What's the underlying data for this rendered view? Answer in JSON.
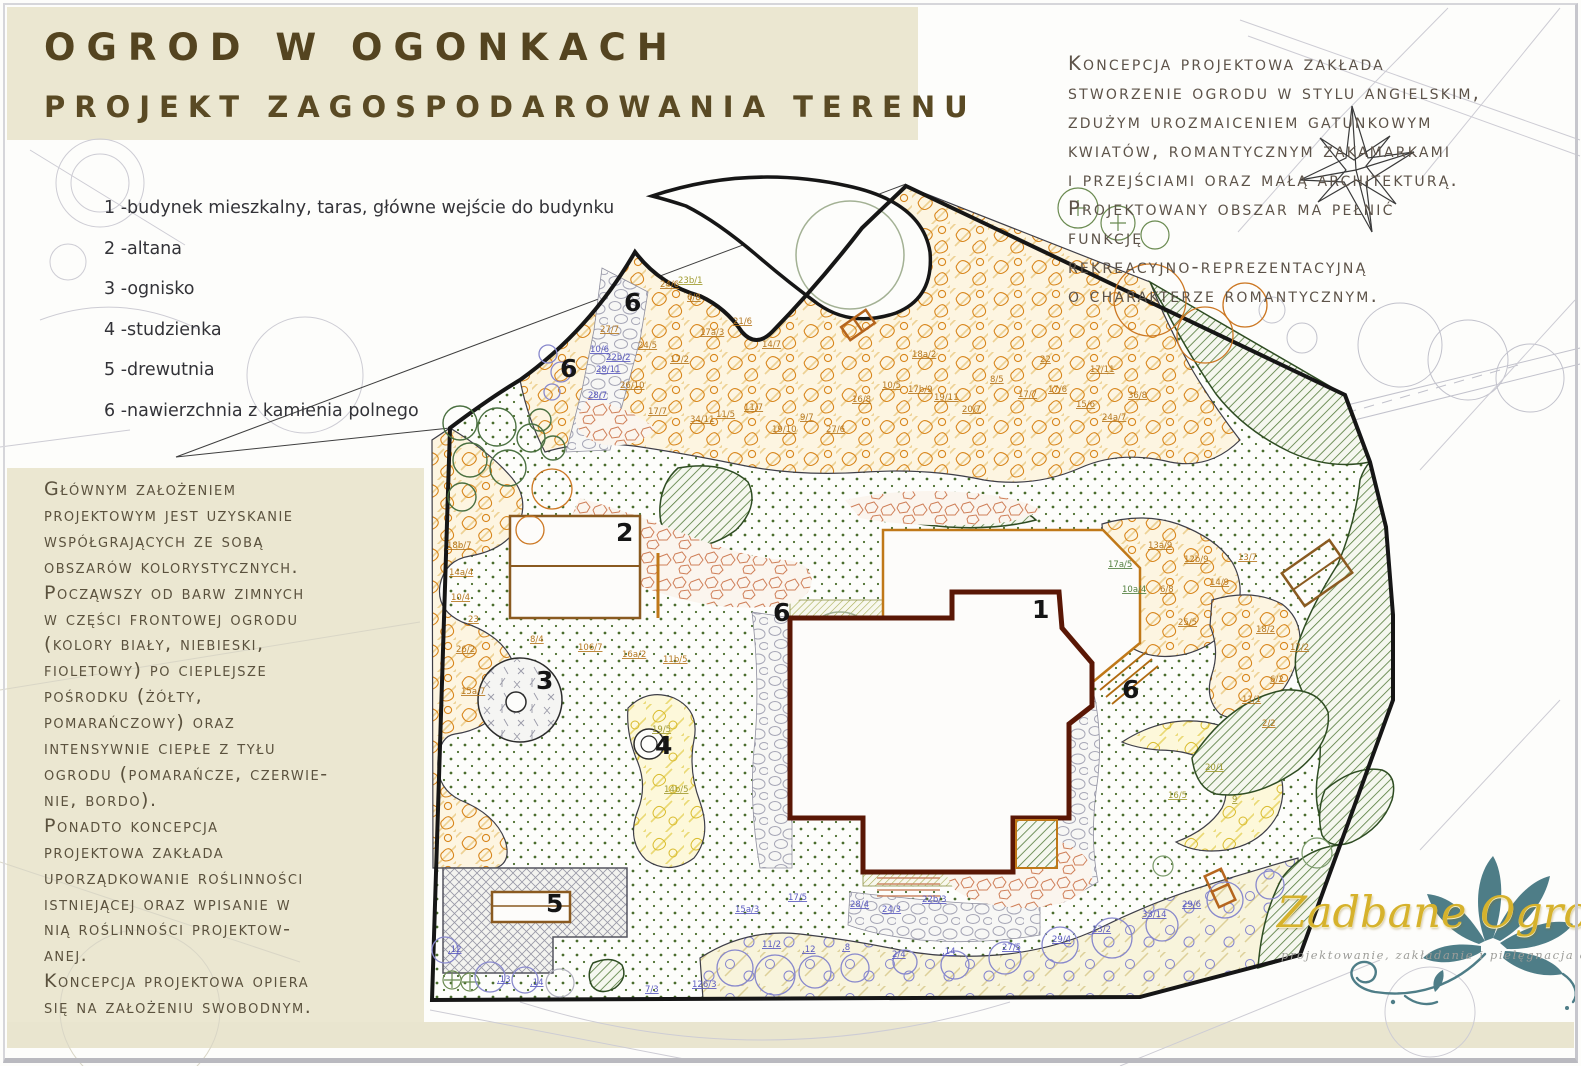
{
  "header": {
    "title_line1": "OGROD W OGONKACH",
    "title_line2": "PROJEKT ZAGOSPODAROWANIA TERENU"
  },
  "legend": {
    "items": [
      "1 -budynek mieszkalny, taras, główne wejście do budynku",
      "2 -altana",
      "3 -ognisko",
      "4 -studzienka",
      "5 -drewutnia",
      "6 -nawierzchnia z kamienia polnego"
    ]
  },
  "concept_note": {
    "lines": [
      "Koncepcja projektowa zakłada",
      "stworzenie ogrodu w stylu angielskim,",
      "zdużym urozmaiceniem gatunkowym",
      "kwiatów, romantycznym zakamarkami",
      "i przejściami oraz małą architekturą.",
      "Projektowany obszar ma pełnić",
      "funkcję",
      "rekreacyjno-reprezentacyjną",
      "o charakterze romantycznym."
    ]
  },
  "design_note": {
    "lines": [
      "Głównym założeniem",
      "projektowym jest uzyskanie",
      "współgrających ze sobą",
      "obszarów kolorystycznych.",
      "Począwszy od barw zimnych",
      "w części frontowej ogrodu",
      "(kolory biały, niebieski,",
      "fioletowy) po cieplejsze",
      "pośrodku (żółty,",
      "pomarańczowy) oraz",
      "intensywnie ciepłe z tyłu",
      "ogrodu (pomarańcze, czerwie-",
      "nie, bordo).",
      "Ponadto koncepcja",
      "projektowa zakłada",
      "uporządkowanie roślinności",
      "istniejącej oraz wpisanie w",
      "nią roślinności projektow-",
      "anej.",
      "Koncepcja projektowa opiera",
      "się na założeniu swobodnym."
    ]
  },
  "plan": {
    "area_labels": [
      {
        "n": "1",
        "x": 1032,
        "y": 618
      },
      {
        "n": "2",
        "x": 616,
        "y": 541
      },
      {
        "n": "3",
        "x": 536,
        "y": 689
      },
      {
        "n": "4",
        "x": 655,
        "y": 754
      },
      {
        "n": "5",
        "x": 546,
        "y": 912
      },
      {
        "n": "6",
        "x": 624,
        "y": 311
      },
      {
        "n": "6",
        "x": 560,
        "y": 377
      },
      {
        "n": "6",
        "x": 773,
        "y": 621
      },
      {
        "n": "6",
        "x": 1122,
        "y": 698
      }
    ],
    "plant_codes": [
      [
        600,
        332,
        "27/7",
        "o"
      ],
      [
        638,
        348,
        "24/5",
        "o"
      ],
      [
        670,
        362,
        "17/2",
        "o"
      ],
      [
        700,
        335,
        "17a/3",
        "o"
      ],
      [
        733,
        324,
        "21/6",
        "o"
      ],
      [
        762,
        347,
        "14/7",
        "o"
      ],
      [
        620,
        388,
        "26/10",
        "o"
      ],
      [
        648,
        414,
        "17/7",
        "o"
      ],
      [
        690,
        422,
        "34/11",
        "o"
      ],
      [
        716,
        417,
        "11/5",
        "o"
      ],
      [
        744,
        410,
        "11/7",
        "o"
      ],
      [
        772,
        432,
        "19/10",
        "o"
      ],
      [
        800,
        420,
        "9/7",
        "o"
      ],
      [
        826,
        432,
        "27/6",
        "o"
      ],
      [
        852,
        402,
        "16/8",
        "o"
      ],
      [
        882,
        388,
        "10/5",
        "o"
      ],
      [
        908,
        392,
        "17b/9",
        "o"
      ],
      [
        934,
        400,
        "19/11",
        "o"
      ],
      [
        962,
        412,
        "20/7",
        "o"
      ],
      [
        990,
        382,
        "8/5",
        "o"
      ],
      [
        1018,
        397,
        "17/7",
        "o"
      ],
      [
        1048,
        392,
        "17/6",
        "o"
      ],
      [
        1076,
        407,
        "15/6",
        "o"
      ],
      [
        1040,
        362,
        "22",
        "o"
      ],
      [
        912,
        357,
        "18a/2",
        "o"
      ],
      [
        1102,
        420,
        "24a/7",
        "o"
      ],
      [
        1128,
        398,
        "36/8",
        "o"
      ],
      [
        1090,
        372,
        "17/11",
        "o"
      ],
      [
        687,
        300,
        "6/8",
        "o"
      ],
      [
        660,
        287,
        "24/6",
        "o"
      ],
      [
        447,
        548,
        "18b/7",
        "o"
      ],
      [
        449,
        575,
        "14a/4",
        "o"
      ],
      [
        451,
        600,
        "10/4",
        "o"
      ],
      [
        456,
        652,
        "26/2",
        "o"
      ],
      [
        461,
        694,
        "15a/7",
        "o"
      ],
      [
        468,
        622,
        "23",
        "o"
      ],
      [
        530,
        642,
        "8/4",
        "o"
      ],
      [
        578,
        650,
        "106/7",
        "o"
      ],
      [
        622,
        657,
        "16a/2",
        "o"
      ],
      [
        663,
        662,
        "11b/5",
        "o"
      ],
      [
        1148,
        548,
        "13a/9",
        "o"
      ],
      [
        1184,
        562,
        "12b/9",
        "o"
      ],
      [
        1160,
        592,
        "6/8",
        "o"
      ],
      [
        1256,
        632,
        "18/2",
        "o"
      ],
      [
        1290,
        650,
        "17/2",
        "o"
      ],
      [
        1270,
        682,
        "6/2",
        "o"
      ],
      [
        1242,
        702,
        "11/1",
        "o"
      ],
      [
        1262,
        726,
        "2/2",
        "o"
      ],
      [
        1178,
        625,
        "25/5",
        "o"
      ],
      [
        1210,
        585,
        "14/9",
        "o"
      ],
      [
        1238,
        560,
        "13/7",
        "o"
      ],
      [
        762,
        947,
        "11/2",
        "b"
      ],
      [
        802,
        952,
        ",12",
        "b"
      ],
      [
        842,
        950,
        ",8",
        "b"
      ],
      [
        892,
        957,
        "2/4",
        "b"
      ],
      [
        942,
        954,
        ",14",
        "b"
      ],
      [
        1002,
        950,
        "27/5",
        "b"
      ],
      [
        1052,
        942,
        "29/4",
        "b"
      ],
      [
        1092,
        932,
        "13/2",
        "b"
      ],
      [
        1142,
        917,
        "33/14",
        "b"
      ],
      [
        1182,
        907,
        "29/6",
        "b"
      ],
      [
        922,
        902,
        "22b/3",
        "b"
      ],
      [
        882,
        912,
        "24/3",
        "b"
      ],
      [
        850,
        907,
        "28/4",
        "b"
      ],
      [
        692,
        987,
        "126/3",
        "b"
      ],
      [
        645,
        992,
        "7/3",
        "b"
      ],
      [
        735,
        912,
        "15a/3",
        "b"
      ],
      [
        788,
        900,
        "17/5",
        "b"
      ],
      [
        590,
        352,
        "10/6",
        "b"
      ],
      [
        596,
        372,
        "28/11",
        "b"
      ],
      [
        588,
        398,
        "28/7",
        "b"
      ],
      [
        606,
        360,
        "22b/2",
        "b"
      ],
      [
        497,
        982,
        ",13",
        "b"
      ],
      [
        530,
        985,
        ",14",
        "b"
      ],
      [
        448,
        952,
        ",12",
        "b"
      ],
      [
        652,
        732,
        "19/5",
        "y"
      ],
      [
        664,
        792,
        "14b/5",
        "y"
      ],
      [
        1168,
        798,
        "16/5",
        "y"
      ],
      [
        1232,
        802,
        "9",
        "y"
      ],
      [
        1205,
        770,
        "20/1",
        "y"
      ],
      [
        678,
        283,
        "23b/1",
        "y"
      ],
      [
        1108,
        567,
        "17a/5",
        "g"
      ],
      [
        1122,
        592,
        "10a/4",
        "g"
      ]
    ]
  },
  "logo": {
    "name": "Zadbane Ogrody",
    "tagline": "projektowanie, zakładanie i pielęgnacja ogrodów"
  },
  "colors": {
    "panel_beige": "#ebe7d1",
    "title_brown": "#544420",
    "boundary_black": "#161616",
    "house_wall": "#5a1705",
    "terrace_orange": "#c07818",
    "green_hatch": "#537a39",
    "lawn_dot": "#4a6d2d",
    "bed_orange": "#d8861c",
    "bed_yellow": "#d9bb2b",
    "bed_blue": "#8383cf",
    "logo_gold": "#d6b22c",
    "logo_teal": "#4e7d87"
  }
}
